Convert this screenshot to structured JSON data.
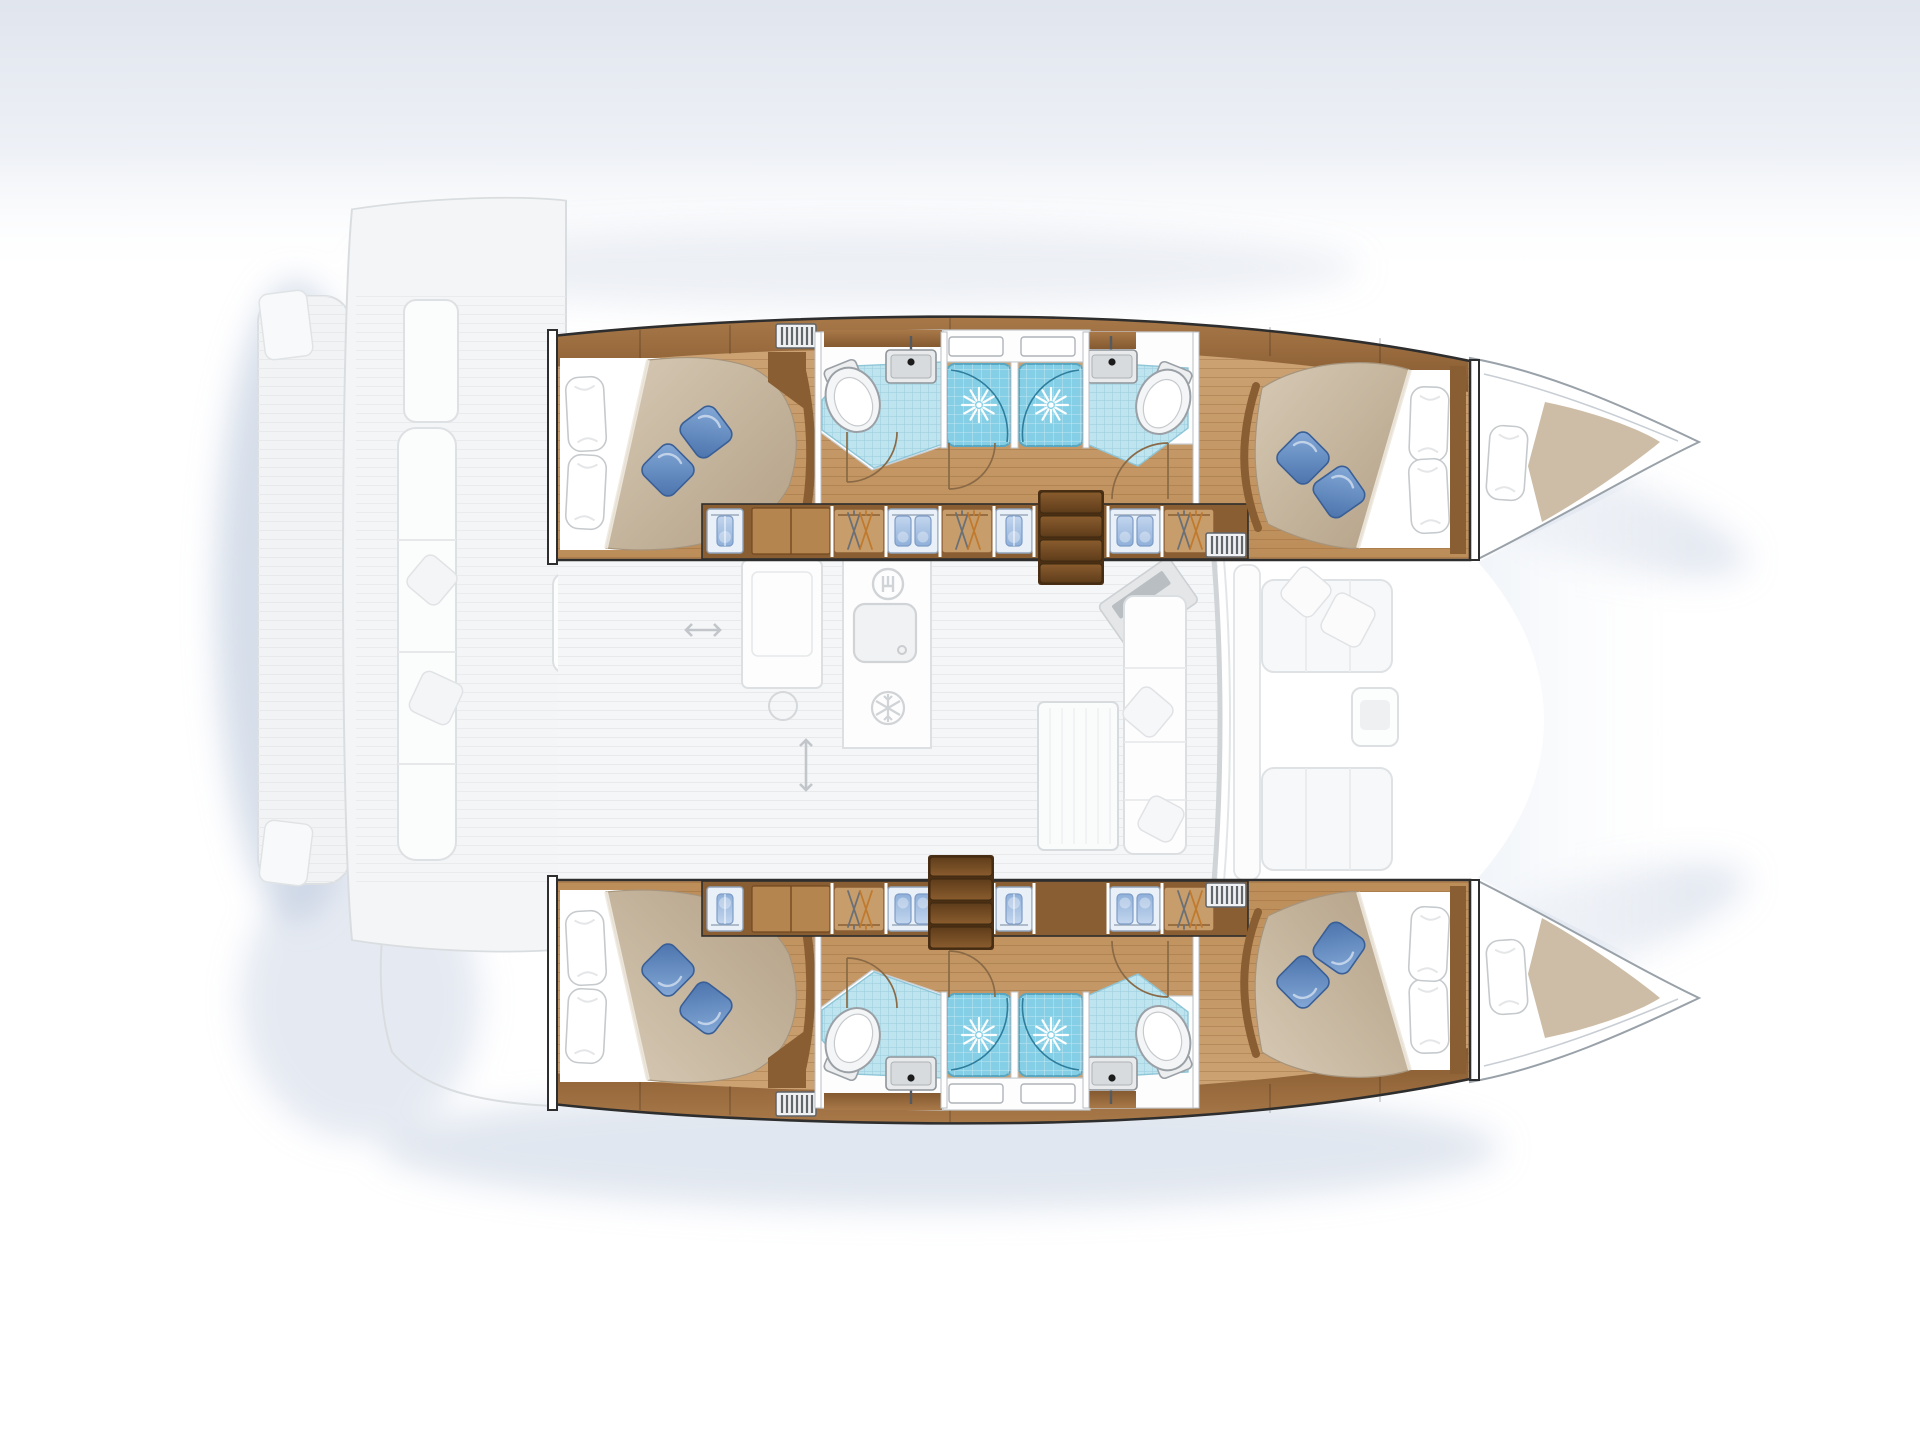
{
  "page": {
    "title": "Catamaran yacht floor plan — 4 double cabins, 4 shower rooms, mirrored twin hulls, ghosted main-deck saloon and cockpits",
    "canvas": {
      "width": 1920,
      "height": 1440
    }
  },
  "palette": {
    "background": "#ffffff",
    "sky_tint": "#e2e7f0",
    "shadow": "#b4c3d9",
    "wood_floor": "#c89a66",
    "wood_floor_line": "#b2824f",
    "wood_furniture": "#8a5e33",
    "wood_furniture_light": "#b5854f",
    "stairs_wood": "#6f4a24",
    "tile_blue": "#bde4ef",
    "shower_blue": "#85cfe6",
    "pillow_blue": "#5d88c0",
    "duvet_beige": "#c7b89f",
    "linen_white": "#ffffff",
    "ghost_fill": "#f3f4f6",
    "ghost_stroke": "#d7dadd",
    "wall_stroke": "#2e2e2e",
    "bow_stroke": "#99a1a9",
    "door_arc": "#8a6a46"
  },
  "plan": {
    "hulls": [
      {
        "id": "port-hull",
        "label": "Port hull (top): aft double cabin with bed and blue cushions, head with toilet and washbasin, two tiled shower stalls, second head, wardrobe lockers with towels and hangers, companionway stairs, forward double cabin, forepeak berth in bow"
      },
      {
        "id": "starboard-hull",
        "label": "Starboard hull (bottom): mirror image of port hull layout"
      }
    ],
    "ghost_deck": {
      "label": "Main deck shown ghosted: aft swim platform, aft cockpit with bench and table, saloon with galley (sink, stove, fridge, cutlery locker), navigation station, dinette table and sofa, forward cockpit seating between the bows"
    },
    "icons": [
      "toilet-icon",
      "washbasin-icon",
      "shower-drain-icon",
      "towel-locker-icon",
      "clothes-hangers-icon",
      "louver-vent-icon",
      "stairs-icon",
      "fridge-snowflake-icon",
      "cutlery-icon",
      "galley-sink-icon",
      "stove-burner-icon",
      "double-arrow-icon",
      "bed-pillow-icon",
      "blue-cushion-icon",
      "nav-station-icon"
    ]
  }
}
